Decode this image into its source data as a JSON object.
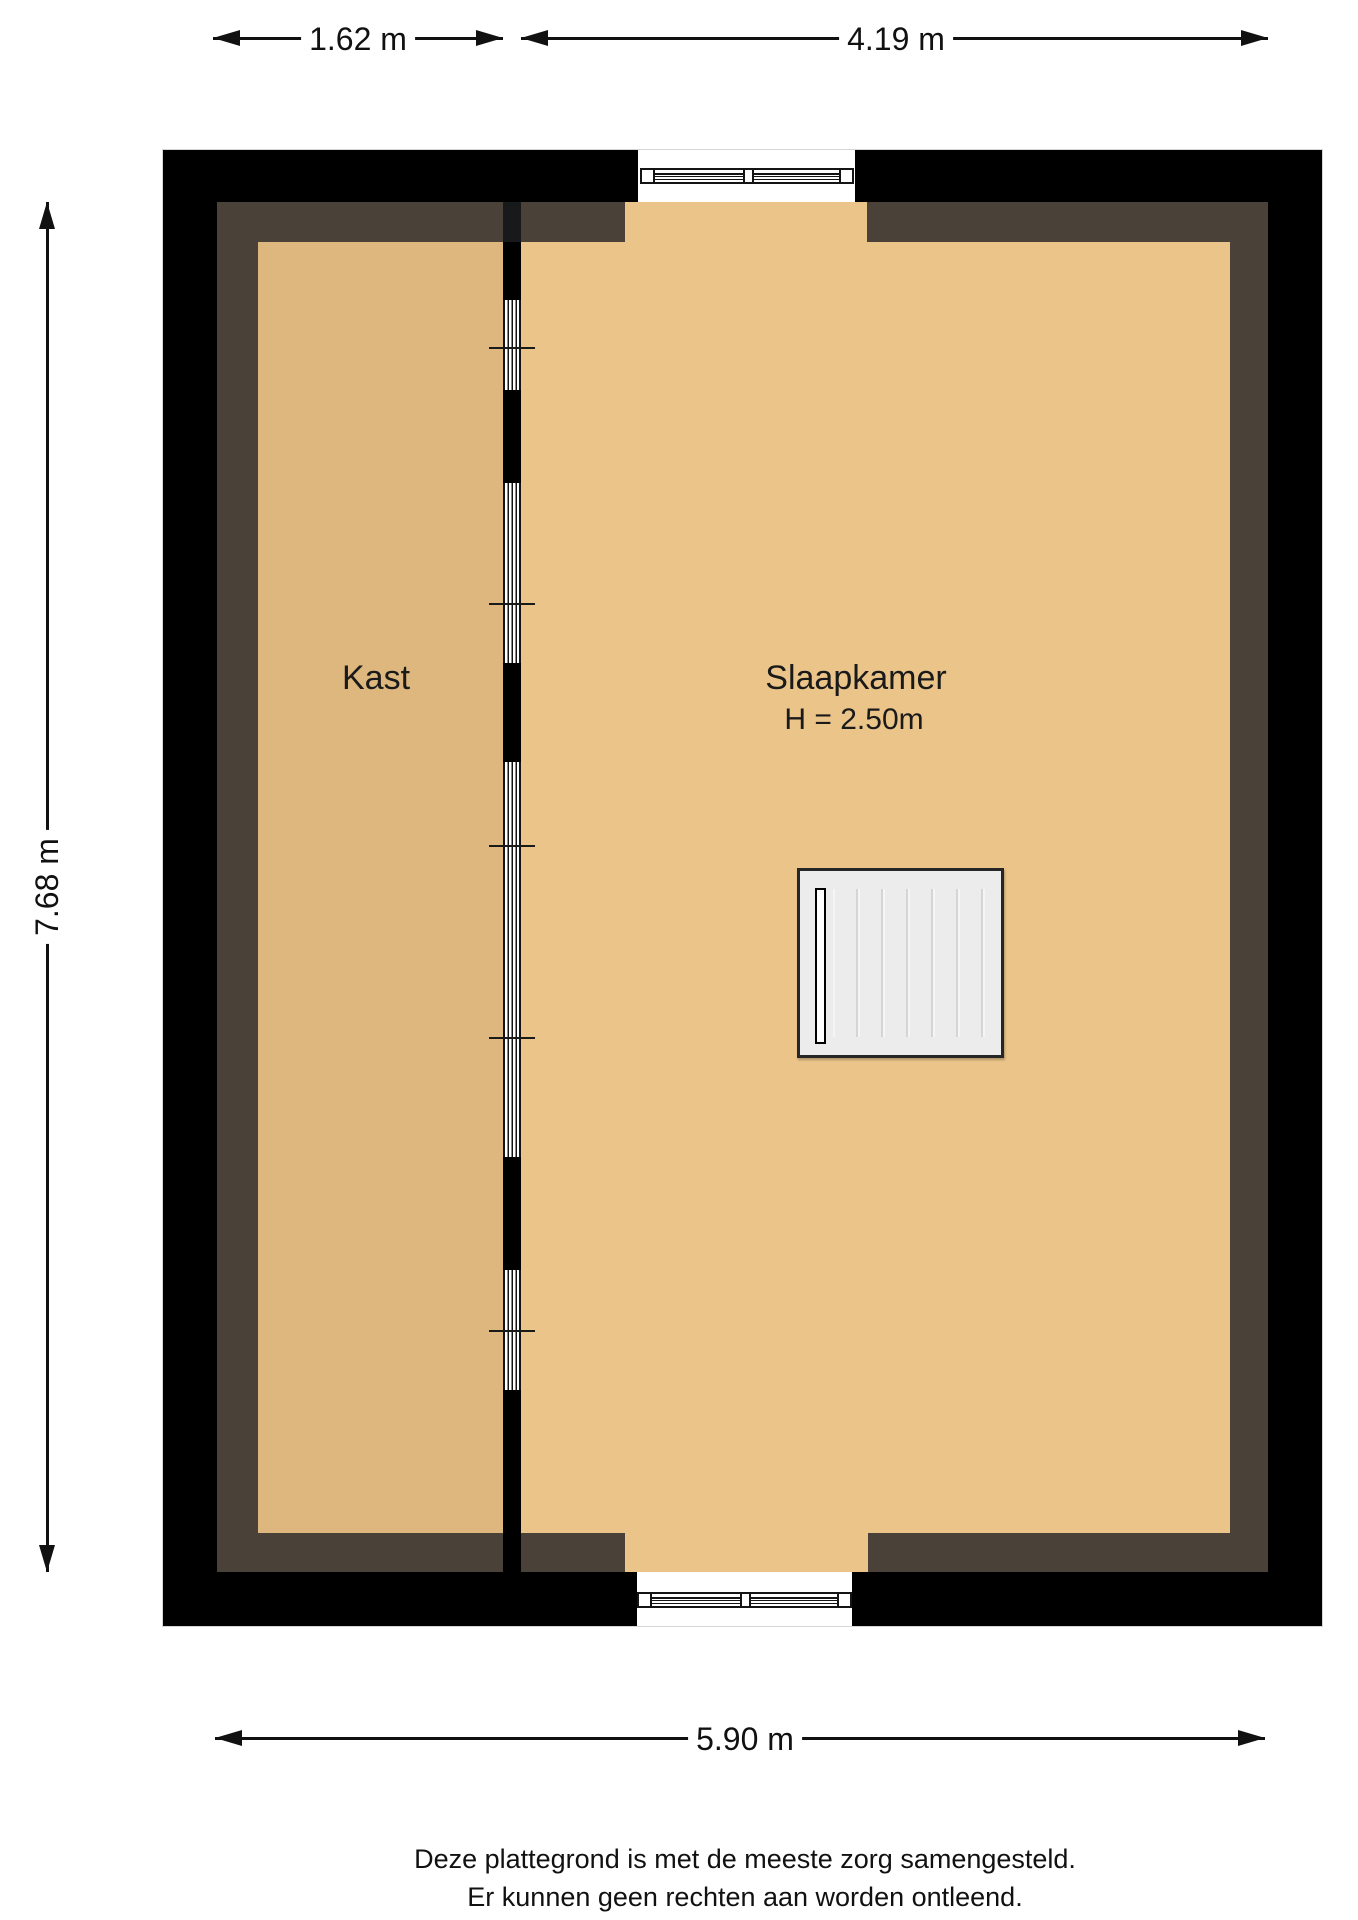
{
  "dimensions": {
    "kast_width": "1.62 m",
    "slaapkamer_width": "4.19 m",
    "total_height": "7.68 m",
    "total_width": "5.90 m"
  },
  "rooms": {
    "kast": {
      "name": "Kast"
    },
    "slaapkamer": {
      "name": "Slaapkamer",
      "ceiling_height": "H = 2.50m"
    }
  },
  "disclaimer": {
    "line1": "Deze plattegrond is met de meeste zorg samengesteld.",
    "line2": "Er kunnen geen rechten aan worden ontleend."
  },
  "colors": {
    "wall": "#000000",
    "wall-inner": "#4a4238",
    "floor-kast": "#ddb77e",
    "floor-slaapkamer": "#eac489",
    "stair-fill": "#ececec",
    "line": "#111111"
  }
}
